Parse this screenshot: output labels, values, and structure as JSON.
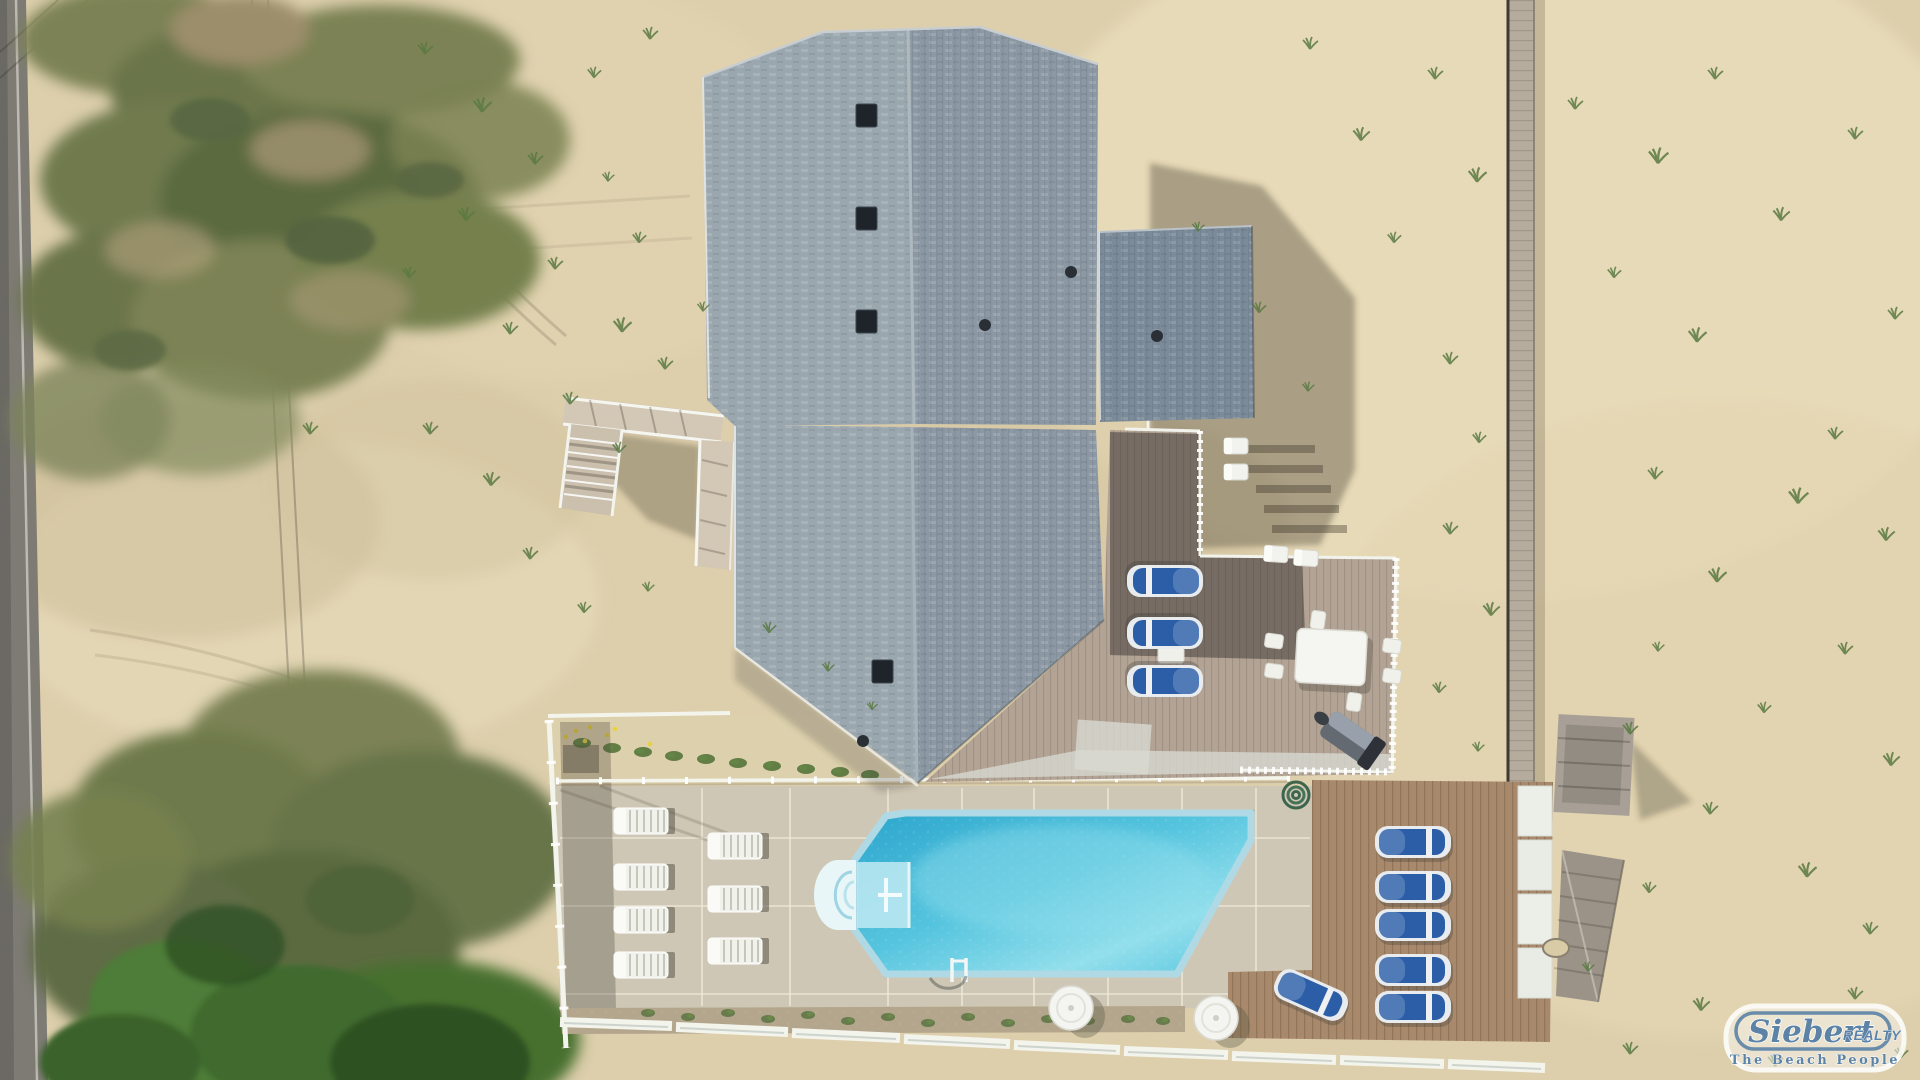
{
  "watermark": {
    "brand": "Siebert",
    "brand_suffix": "REALTY",
    "tagline": "The Beach People"
  },
  "scene": {
    "description": "Aerial drone photo of an oceanfront beach house with gray shingled gable roofs, an inground pool with white rim and steps, concrete pool deck with white lounge chairs, composite sun deck with blue loungers, white dining set and grill, wooden deck with a row of blue loungers, white perimeter fence, dune boardwalk, sandy lot with scrub vegetation and a road on the left",
    "colors": {
      "sand": "#ddcfac",
      "sand_light": "#e9dcba",
      "sand_shadow": "#8d836c",
      "road": "#7d7b74",
      "veg_olive": "#7c8254",
      "veg_dark": "#5c6b40",
      "veg_bright": "#4e7d37",
      "veg_deep": "#2e5124",
      "roof_light": "#9ba7af",
      "roof_mid": "#8c99a4",
      "roof_dark": "#7b8b99",
      "concrete": "#cfc7b5",
      "seam": "#ece7d8",
      "deck_wood": "#a8896b",
      "deck_comp": "#b2a394",
      "fence_white": "#f3f4ec",
      "pool_rim": "#eef6f6",
      "water_deep": "#2ca6cd",
      "water_mid": "#55c4de",
      "water_light": "#93dfec",
      "lounger_blue": "#2b5ea7",
      "gravel": "#b3a68c",
      "logo_blue": "#5c83a6"
    },
    "counts": {
      "white_loungers": 7,
      "blue_loungers": 9,
      "dining_chairs": 6,
      "round_tables": 2
    }
  },
  "furniture": {
    "white_loungers": [
      [
        612,
        806
      ],
      [
        612,
        862
      ],
      [
        612,
        905
      ],
      [
        612,
        950
      ],
      [
        706,
        831
      ],
      [
        706,
        884
      ],
      [
        706,
        936
      ]
    ],
    "blue_loungers": [
      [
        1374,
        823,
        0
      ],
      [
        1374,
        868,
        0
      ],
      [
        1374,
        906,
        0
      ],
      [
        1374,
        951,
        0
      ],
      [
        1374,
        988,
        0
      ],
      [
        1272,
        976,
        24
      ],
      [
        1126,
        562,
        180
      ],
      [
        1126,
        614,
        180
      ],
      [
        1126,
        662,
        180
      ]
    ],
    "dining_chairs": [
      [
        1264,
        633,
        8
      ],
      [
        1264,
        663,
        8
      ],
      [
        1382,
        638,
        8
      ],
      [
        1382,
        668,
        8
      ],
      [
        1308,
        612,
        98
      ],
      [
        1344,
        694,
        98
      ]
    ],
    "small_chairs": [
      [
        1262,
        544,
        4
      ],
      [
        1292,
        548,
        4
      ],
      [
        1222,
        436,
        0
      ],
      [
        1222,
        462,
        0
      ]
    ],
    "round_tables": [
      [
        1041,
        978
      ],
      [
        1186,
        988
      ]
    ]
  },
  "landscape": {
    "grass_tufts": [
      [
        415,
        40,
        1
      ],
      [
        470,
        95,
        1.2
      ],
      [
        525,
        150,
        1
      ],
      [
        585,
        65,
        0.9
      ],
      [
        640,
        25,
        1
      ],
      [
        455,
        205,
        1.1
      ],
      [
        400,
        265,
        0.9
      ],
      [
        545,
        255,
        1
      ],
      [
        610,
        315,
        1.2
      ],
      [
        655,
        355,
        1
      ],
      [
        695,
        300,
        0.8
      ],
      [
        500,
        320,
        1
      ],
      [
        560,
        390,
        1
      ],
      [
        610,
        440,
        0.9
      ],
      [
        480,
        470,
        1.1
      ],
      [
        420,
        420,
        1
      ],
      [
        300,
        420,
        1
      ],
      [
        520,
        545,
        1
      ],
      [
        575,
        600,
        0.9
      ],
      [
        640,
        580,
        0.8
      ],
      [
        760,
        620,
        0.9
      ],
      [
        820,
        660,
        0.8
      ],
      [
        865,
        700,
        0.7
      ],
      [
        1300,
        35,
        1
      ],
      [
        1350,
        125,
        1.1
      ],
      [
        1425,
        65,
        1
      ],
      [
        1465,
        165,
        1.2
      ],
      [
        1385,
        230,
        0.9
      ],
      [
        1565,
        95,
        1
      ],
      [
        1645,
        145,
        1.3
      ],
      [
        1705,
        65,
        1
      ],
      [
        1770,
        205,
        1.1
      ],
      [
        1845,
        125,
        1
      ],
      [
        1885,
        305,
        1
      ],
      [
        1685,
        325,
        1.2
      ],
      [
        1605,
        265,
        0.9
      ],
      [
        1825,
        425,
        1
      ],
      [
        1875,
        525,
        1.1
      ],
      [
        1785,
        485,
        1.3
      ],
      [
        1645,
        465,
        1
      ],
      [
        1705,
        565,
        1.2
      ],
      [
        1835,
        640,
        1
      ],
      [
        1880,
        750,
        1.1
      ],
      [
        1755,
        700,
        0.9
      ],
      [
        1650,
        640,
        0.8
      ],
      [
        1620,
        720,
        1
      ],
      [
        1700,
        800,
        1
      ],
      [
        1795,
        860,
        1.2
      ],
      [
        1860,
        920,
        1
      ],
      [
        1640,
        880,
        0.9
      ],
      [
        1580,
        960,
        0.8
      ],
      [
        1620,
        1040,
        1
      ],
      [
        1690,
        995,
        1.1
      ],
      [
        1765,
        1052,
        1
      ],
      [
        1845,
        985,
        1
      ],
      [
        1892,
        1045,
        0.9
      ],
      [
        1190,
        220,
        0.8
      ],
      [
        1250,
        300,
        0.9
      ],
      [
        1300,
        380,
        0.8
      ],
      [
        600,
        170,
        0.8
      ],
      [
        630,
        230,
        0.9
      ],
      [
        1440,
        350,
        1
      ],
      [
        1470,
        430,
        0.9
      ],
      [
        1440,
        520,
        1
      ],
      [
        1480,
        600,
        1.1
      ],
      [
        1430,
        680,
        0.9
      ],
      [
        1470,
        740,
        0.8
      ]
    ],
    "flower_plants": [
      [
        572,
        737
      ],
      [
        602,
        742
      ],
      [
        633,
        746
      ],
      [
        664,
        750
      ],
      [
        696,
        753
      ],
      [
        728,
        757
      ],
      [
        762,
        760
      ],
      [
        796,
        763
      ],
      [
        830,
        766
      ],
      [
        860,
        769
      ]
    ],
    "flowers": [
      [
        576,
        731
      ],
      [
        590,
        727
      ],
      [
        607,
        735
      ],
      [
        585,
        741
      ],
      [
        615,
        729
      ],
      [
        650,
        744
      ],
      [
        566,
        737
      ]
    ],
    "gravel_plants": [
      [
        640,
        1008
      ],
      [
        680,
        1012
      ],
      [
        720,
        1008
      ],
      [
        760,
        1014
      ],
      [
        800,
        1010
      ],
      [
        840,
        1016
      ],
      [
        880,
        1012
      ],
      [
        920,
        1018
      ],
      [
        960,
        1012
      ],
      [
        1000,
        1018
      ],
      [
        1040,
        1014
      ],
      [
        1080,
        1016
      ],
      [
        1120,
        1014
      ],
      [
        1155,
        1016
      ]
    ]
  },
  "structures": {
    "roof_vents_square": [
      [
        856,
        104
      ],
      [
        856,
        207
      ],
      [
        856,
        310
      ],
      [
        872,
        660
      ]
    ],
    "roof_vents_round": [
      [
        985,
        325
      ],
      [
        1071,
        272
      ],
      [
        863,
        741
      ],
      [
        1157,
        336
      ]
    ],
    "concrete_seams_v": [
      702,
      790,
      888,
      962,
      1034,
      1108,
      1182,
      1256
    ],
    "concrete_seams_h": [
      838,
      906,
      994
    ],
    "fence_panels": [
      [
        560,
        1022,
        672,
        1026
      ],
      [
        676,
        1027,
        788,
        1032
      ],
      [
        792,
        1033,
        900,
        1038
      ],
      [
        904,
        1039,
        1010,
        1044
      ],
      [
        1014,
        1045,
        1120,
        1050
      ],
      [
        1124,
        1051,
        1228,
        1055
      ],
      [
        1232,
        1056,
        1336,
        1060
      ],
      [
        1340,
        1060,
        1444,
        1064
      ],
      [
        1448,
        1064,
        1545,
        1068
      ]
    ]
  }
}
